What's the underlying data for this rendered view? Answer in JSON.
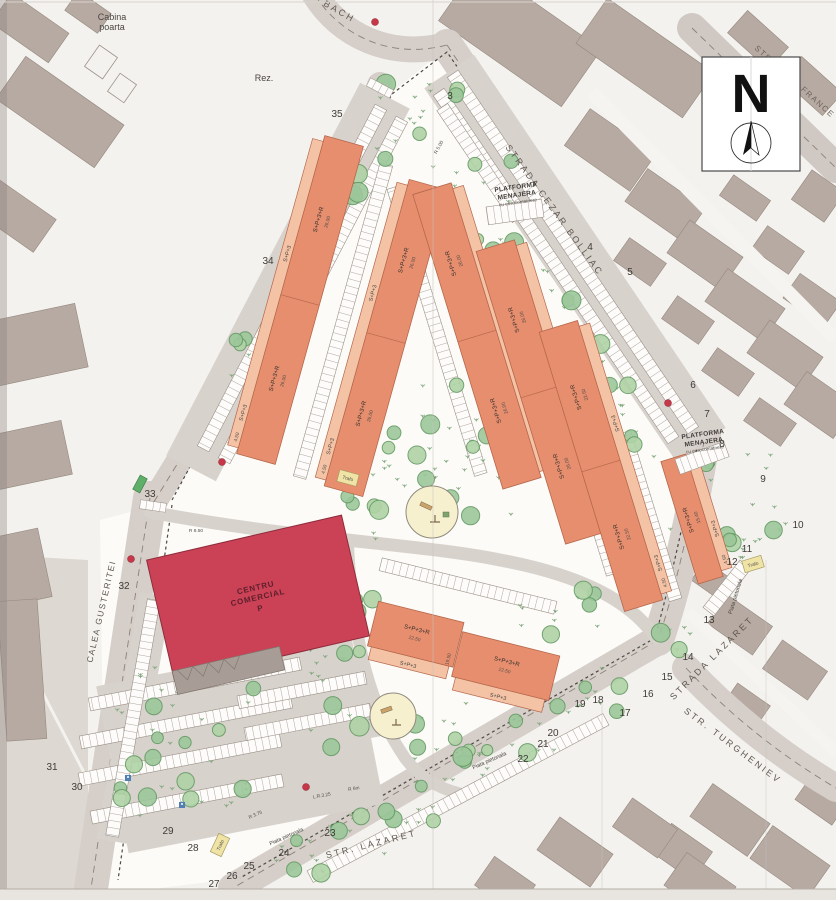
{
  "map": {
    "north_letter": "N",
    "streets": {
      "bach": "BACH",
      "france_a": "STR.",
      "france_b": "FRANCE",
      "cezar_bolliac": "STRADA CEZAR BOLLIAC",
      "lazaret_right": "STRADA LAZARET",
      "lazaret_bottom": "STR. LAZARET",
      "turgheniev": "STR. TURGHENIEV",
      "gusteritei": "CALEA GUSTERITEI"
    },
    "site_labels": {
      "cabina_line1": "Cabina",
      "cabina_line2": "poarta",
      "rez": "Rez.",
      "platforma_line1": "PLATFORMA",
      "platforma_line2": "MENAJERA",
      "platforma_line3": "cu eurocontainere",
      "centru_line1": "CENTRU",
      "centru_line2": "COMERCIAL",
      "centru_line3": "P",
      "trafo": "Trafo",
      "piata_pietonala": "Piata pietonala"
    },
    "building_labels": {
      "slab": "S+P+3+R",
      "strip": "S+P+3"
    },
    "dims": {
      "a": "22.50",
      "b": "26.00",
      "c": "4.50",
      "d": "19.50",
      "e": "15.40"
    },
    "radius_labels": {
      "r500": "R 5.00",
      "r850": "R 8.50",
      "r375": "R 3.75",
      "r6m": "R 6m",
      "lr325": "L.R.3.25"
    },
    "plot_numbers": [
      {
        "n": "3",
        "x": 450,
        "y": 99
      },
      {
        "n": "4",
        "x": 590,
        "y": 250
      },
      {
        "n": "5",
        "x": 630,
        "y": 275
      },
      {
        "n": "6",
        "x": 693,
        "y": 388
      },
      {
        "n": "7",
        "x": 707,
        "y": 417
      },
      {
        "n": "8",
        "x": 722,
        "y": 447
      },
      {
        "n": "9",
        "x": 763,
        "y": 482
      },
      {
        "n": "10",
        "x": 798,
        "y": 528
      },
      {
        "n": "11",
        "x": 747,
        "y": 552
      },
      {
        "n": "12",
        "x": 732,
        "y": 565
      },
      {
        "n": "13",
        "x": 709,
        "y": 623
      },
      {
        "n": "14",
        "x": 688,
        "y": 660
      },
      {
        "n": "15",
        "x": 667,
        "y": 680
      },
      {
        "n": "16",
        "x": 648,
        "y": 697
      },
      {
        "n": "17",
        "x": 625,
        "y": 716
      },
      {
        "n": "18",
        "x": 598,
        "y": 703
      },
      {
        "n": "19",
        "x": 580,
        "y": 707
      },
      {
        "n": "20",
        "x": 553,
        "y": 736
      },
      {
        "n": "21",
        "x": 543,
        "y": 747
      },
      {
        "n": "22",
        "x": 523,
        "y": 762
      },
      {
        "n": "23",
        "x": 330,
        "y": 836
      },
      {
        "n": "24",
        "x": 284,
        "y": 856
      },
      {
        "n": "25",
        "x": 249,
        "y": 869
      },
      {
        "n": "26",
        "x": 232,
        "y": 879
      },
      {
        "n": "27",
        "x": 214,
        "y": 887
      },
      {
        "n": "28",
        "x": 193,
        "y": 851
      },
      {
        "n": "29",
        "x": 168,
        "y": 834
      },
      {
        "n": "30",
        "x": 77,
        "y": 790
      },
      {
        "n": "31",
        "x": 52,
        "y": 770
      },
      {
        "n": "32",
        "x": 124,
        "y": 589
      },
      {
        "n": "33",
        "x": 150,
        "y": 497
      },
      {
        "n": "34",
        "x": 268,
        "y": 264
      },
      {
        "n": "35",
        "x": 337,
        "y": 117
      }
    ]
  }
}
